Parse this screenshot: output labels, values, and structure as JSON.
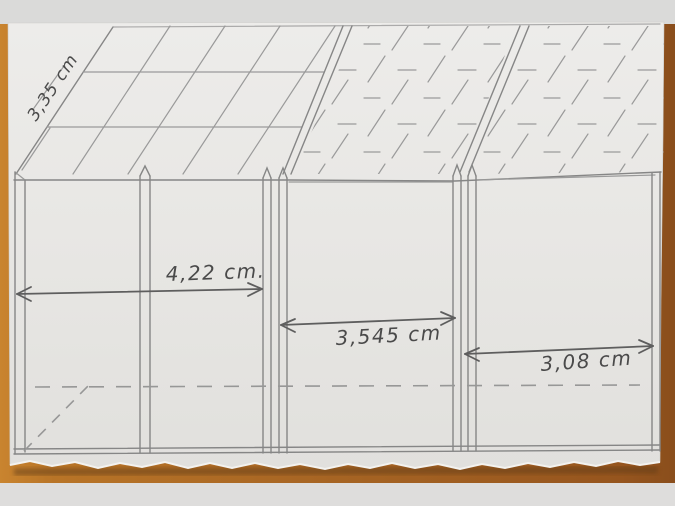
{
  "measurements": {
    "roof_slope": "3,35 cm",
    "left_section": "4,22 cm.",
    "middle_section": "3,545 cm",
    "right_section": "3,08 cm"
  },
  "colors": {
    "paper": "#e8e7e4",
    "pencil_light": "#9a9a9a",
    "pencil": "#868686",
    "pencil_dark": "#5e5e5e",
    "handwriting": "#4a4a4a",
    "wood_light": "#c9842f",
    "wood_dark": "#8a4e1c",
    "band_gray": "#dadad9"
  }
}
